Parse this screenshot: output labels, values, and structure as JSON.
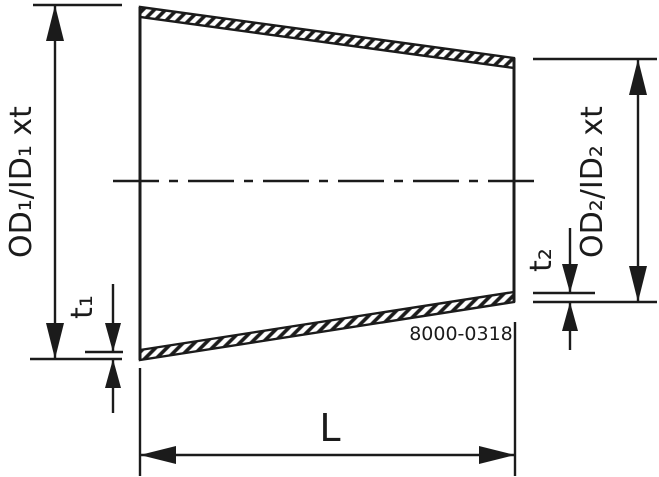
{
  "drawing": {
    "description": "Technical dimension drawing of a concentric pipe reducer (tapered fitting) with hatched wall sections, centerline, and dimension callouts",
    "labels": {
      "od1": "OD₁/ID₁ xt",
      "od2": "OD₂/ID₂ xt",
      "t1": "t₁",
      "t2": "t₂",
      "length": "L",
      "part_number": "8000-0318"
    },
    "colors": {
      "line": "#1b1b1b",
      "background": "#ffffff"
    }
  }
}
